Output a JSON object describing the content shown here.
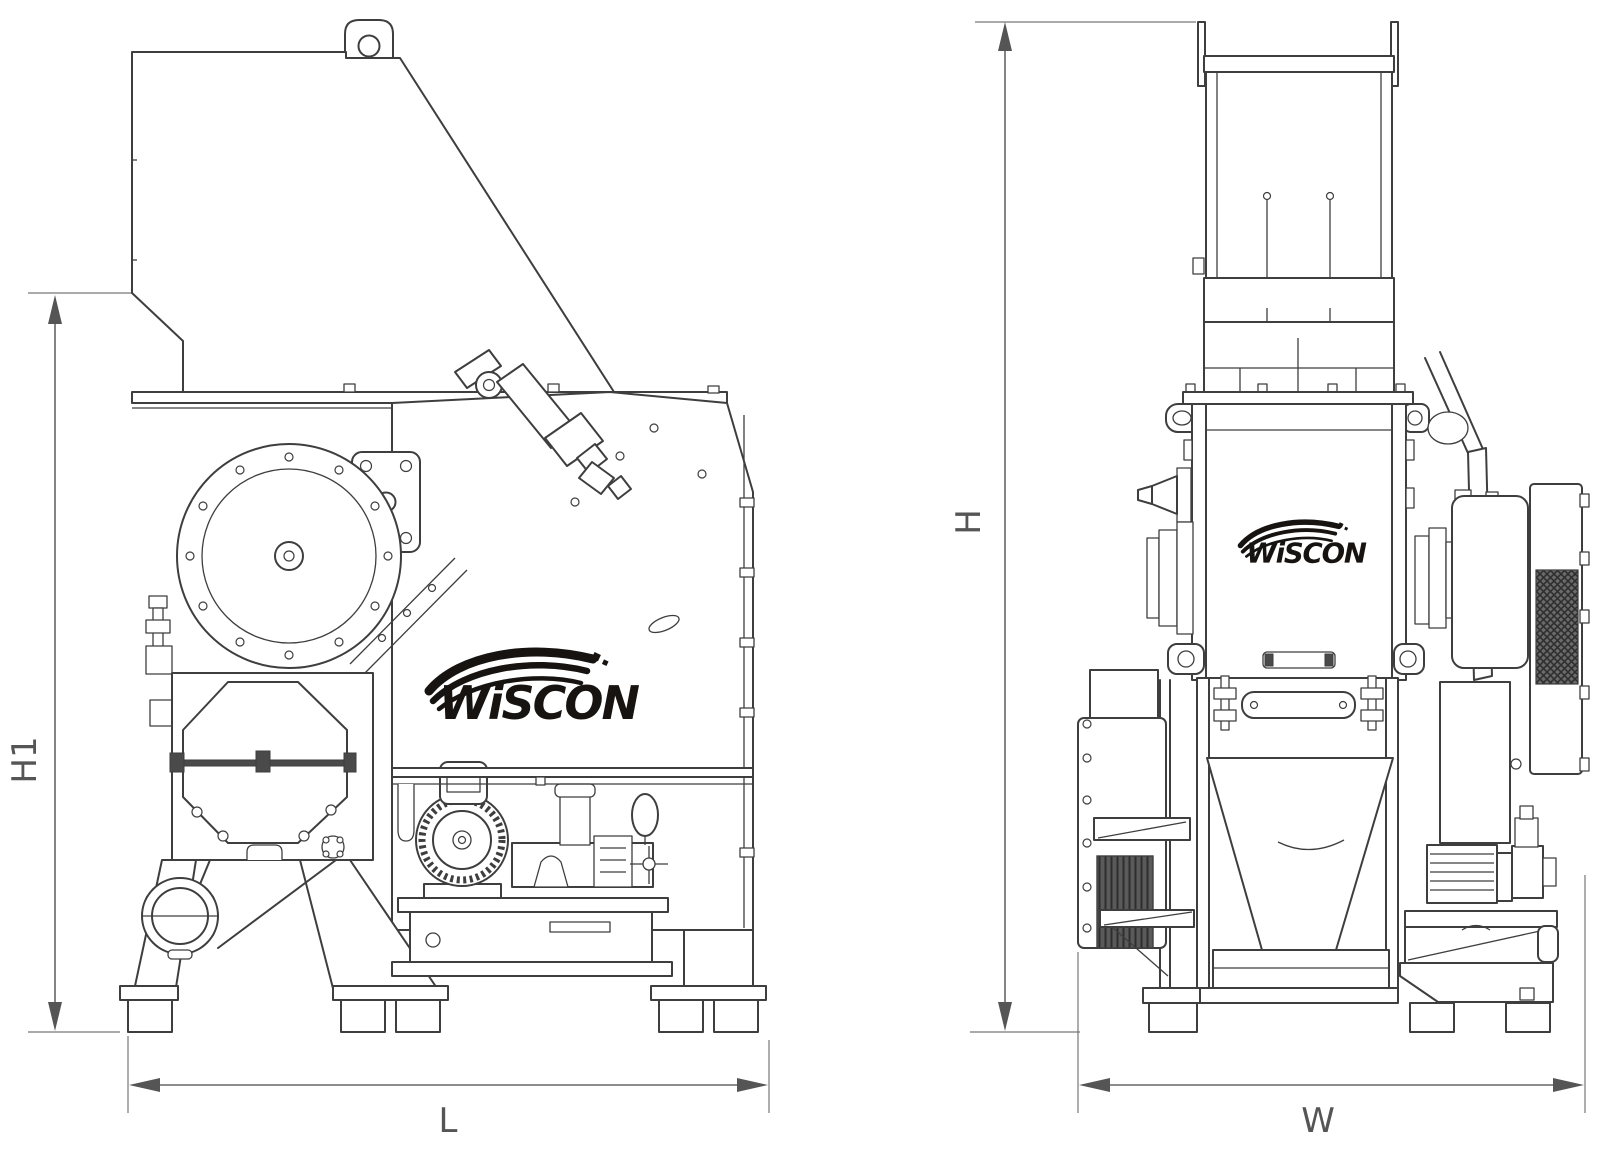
{
  "brand": {
    "name": "WiSCON"
  },
  "views": {
    "front": {
      "dimensions": {
        "height_label": "H1",
        "length_label": "L"
      }
    },
    "side": {
      "dimensions": {
        "height_label": "H",
        "width_label": "W"
      }
    }
  },
  "colors": {
    "line": "#3e3e3e",
    "dimension": "#555555",
    "logo": "#171310",
    "background": "#ffffff"
  }
}
